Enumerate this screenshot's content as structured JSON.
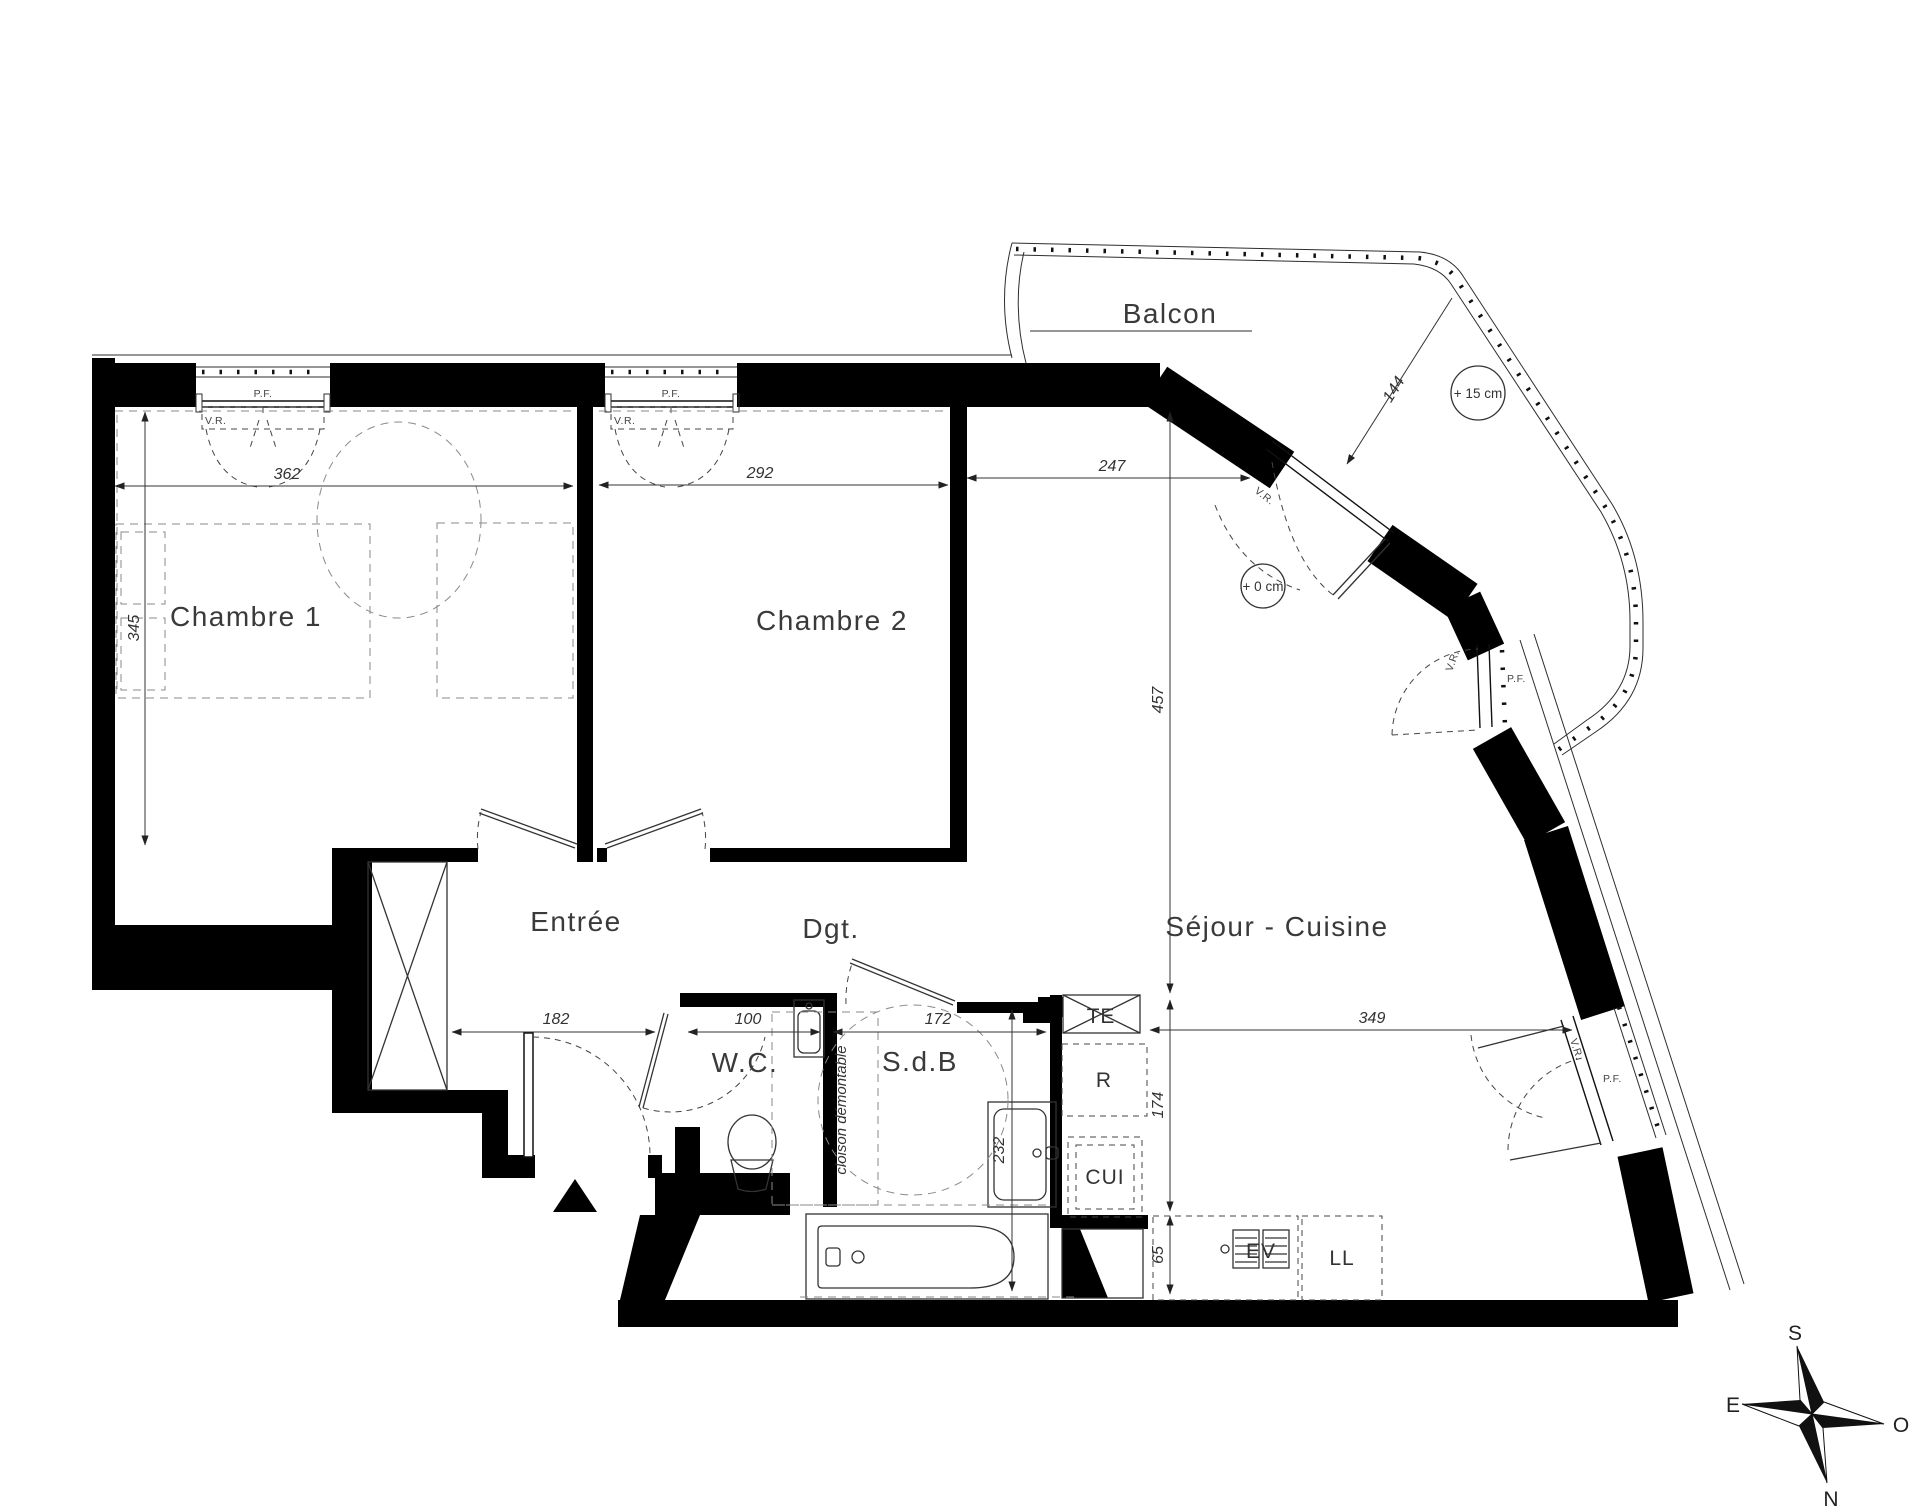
{
  "plan": {
    "rooms": {
      "chambre1": "Chambre 1",
      "chambre2": "Chambre 2",
      "entree": "Entrée",
      "dgt": "Dgt.",
      "wc": "W.C.",
      "sdb": "S.d.B",
      "sejour": "Séjour - Cuisine",
      "balcon": "Balcon"
    },
    "dimensions_cm": {
      "d362": "362",
      "d292": "292",
      "d247": "247",
      "d345": "345",
      "d457": "457",
      "d144": "144",
      "d182": "182",
      "d100": "100",
      "d172": "172",
      "d232": "232",
      "d349": "349",
      "d174": "174",
      "d65": "65"
    },
    "levels": {
      "plus15": "+ 15 cm",
      "plus0": "+ 0 cm"
    },
    "window_labels": {
      "pf": "P.F.",
      "vr": "V.R."
    },
    "annotations": {
      "cloison": "cloison démontable"
    },
    "equipment": {
      "te": "TE",
      "r": "R",
      "cui": "CUI",
      "ev": "EV",
      "ll": "LL"
    },
    "compass": {
      "south": "S",
      "north": "N",
      "east": "E",
      "west": "O"
    }
  }
}
